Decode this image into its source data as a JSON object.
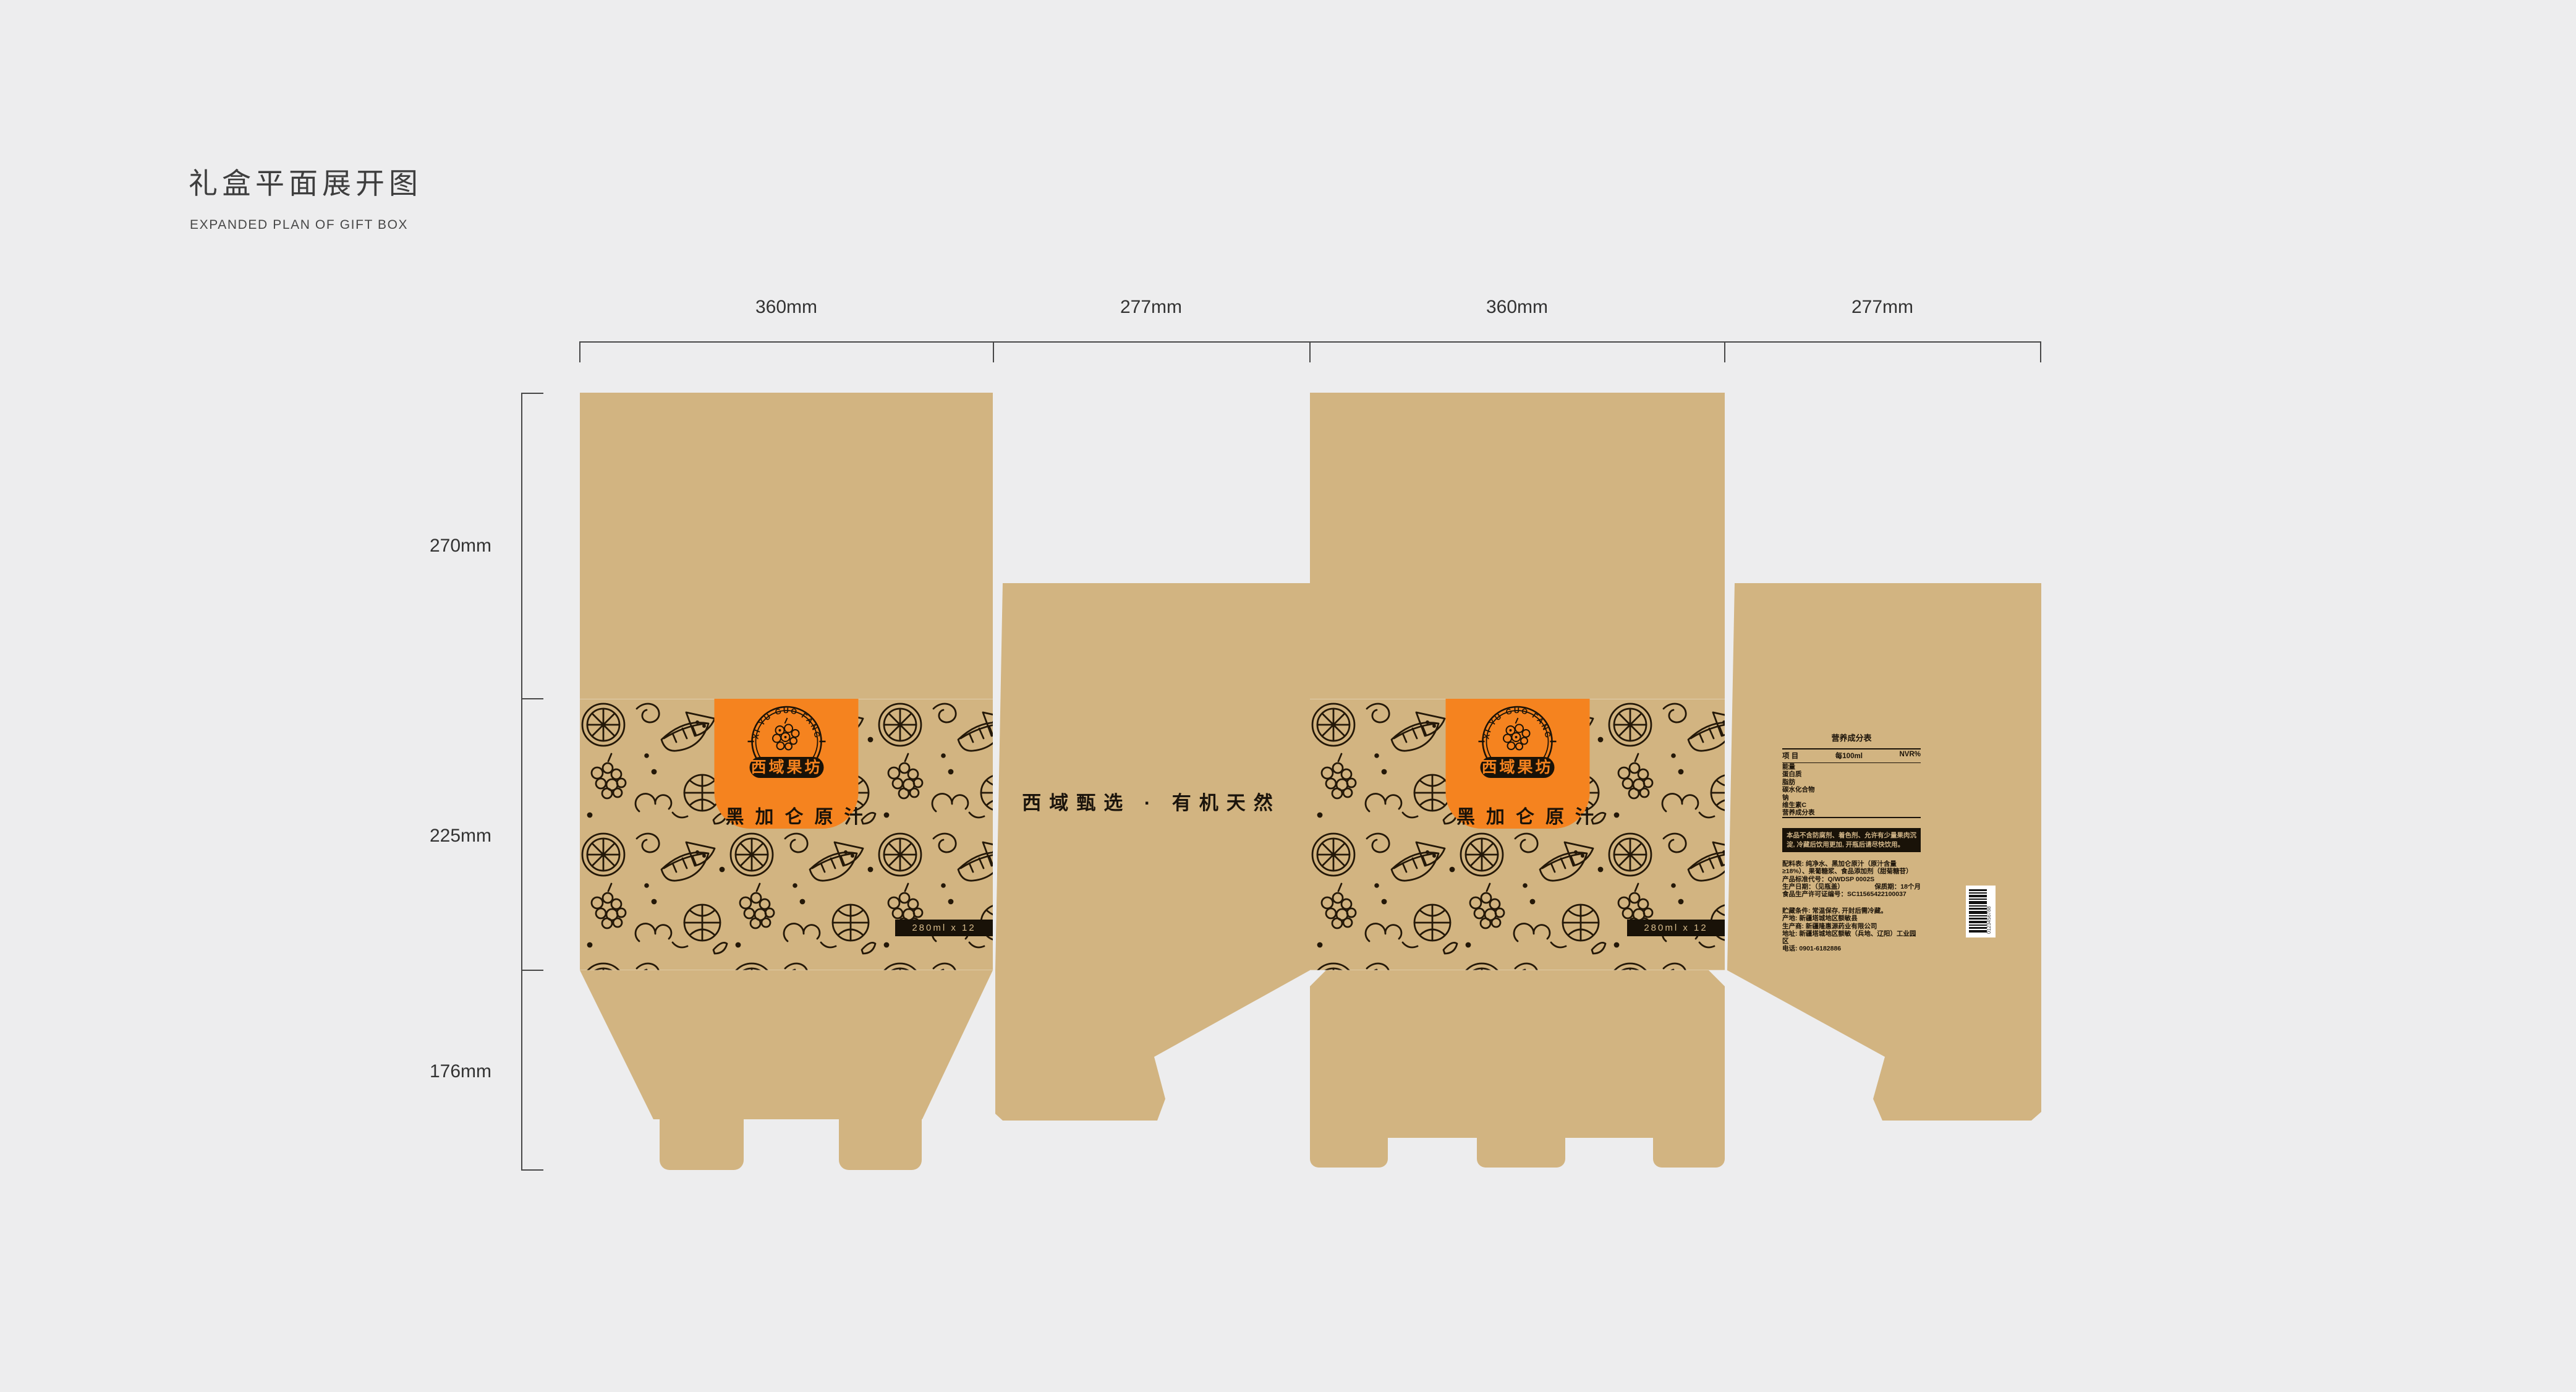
{
  "page": {
    "title_zh": "礼盒平面展开图",
    "title_en": "EXPANDED PLAN OF GIFT BOX"
  },
  "dimensions": {
    "top": [
      "360mm",
      "277mm",
      "360mm",
      "277mm"
    ],
    "left": [
      "270mm",
      "225mm",
      "176mm"
    ]
  },
  "colors": {
    "bg": "#EDEDEE",
    "kraft": "#D2B481",
    "orange": "#F5831F",
    "ink": "#191208"
  },
  "brand": {
    "arc_text": "XI YU GUO FANG",
    "name": "西域果坊",
    "product": "黑加仑原汁",
    "capacity": "280ml x 12"
  },
  "side": {
    "slogan": "西域甄选 · 有机天然"
  },
  "info": {
    "nutrition": {
      "title": "营养成分表",
      "col_item": "项  目",
      "col_per": "每100ml",
      "col_nrv": "NVR%",
      "rows": [
        "能量",
        "蛋白质",
        "脂肪",
        "碳水化合物",
        "钠",
        "维生素C",
        "营养成分表"
      ]
    },
    "notice": "本品不含防腐剂、着色剂、允许有少量果肉沉淀, 冷藏后饮用更加, 开瓶后请尽快饮用。",
    "ingredients": "配料表: 纯净水、黑加仑原汁（原汁含量≥18%）、果葡糖浆、食品添加剂（甜菊糖苷）",
    "standard": "产品标准代号：Q/WDSP 0002S",
    "date": "生产日期：（见瓶盖）",
    "shelf": "保质期：18个月",
    "license": "食品生产许可证编号：SC11565422100037",
    "storage": "贮藏条件: 常温保存, 开封后需冷藏。",
    "origin": "产地: 新疆塔城地区额敏县",
    "manufacturer": "生产商: 新疆隆惠源药业有限公司",
    "address": "地址: 新疆塔城地区额敏（兵地、辽阳）工业园区",
    "phone": "电话: 0901-6182886",
    "barcode": "0123456788"
  }
}
